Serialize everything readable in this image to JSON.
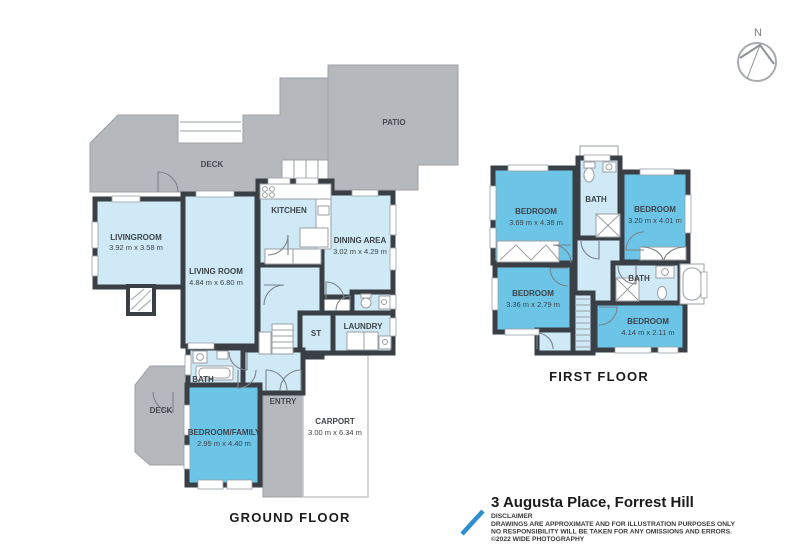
{
  "compass": {
    "label": "N"
  },
  "plan_title": "3 Augusta Place, Forrest Hill",
  "disclaimer": {
    "heading": "DISCLAIMER",
    "line1": "DRAWINGS ARE APPROXIMATE AND FOR ILLUSTRATION PURPOSES ONLY",
    "line2": "NO RESPONSIBILITY WILL BE TAKEN FOR ANY OMISSIONS AND ERRORS.",
    "line3": "©2022 WIDE PHOTOGRAPHY"
  },
  "colors": {
    "wall": "#3a3f46",
    "room_light": "#cfe9f6",
    "room_medium": "#6cc4e7",
    "outdoor_gray": "#b5b8bc",
    "accent_blue": "#2e8fd0"
  },
  "ground_floor": {
    "label": "GROUND FLOOR",
    "outdoor": {
      "deck_top": "DECK",
      "patio": "PATIO",
      "deck_lower": "DECK",
      "entry": "ENTRY"
    },
    "rooms": {
      "livingroom": {
        "name": "LIVINGROOM",
        "dims": "3.92 m x 3.58 m"
      },
      "living_room": {
        "name": "LIVING ROOM",
        "dims": "4.84 m x 6.80 m"
      },
      "kitchen": {
        "name": "KITCHEN"
      },
      "dining_area": {
        "name": "DINING AREA",
        "dims": "3.02 m x 4.29 m"
      },
      "st": {
        "name": "ST"
      },
      "laundry": {
        "name": "LAUNDRY"
      },
      "bath": {
        "name": "BATH"
      },
      "bedroom_family": {
        "name": "BEDROOM/FAMILY",
        "dims": "2.95 m x 4.40 m"
      },
      "carport": {
        "name": "CARPORT",
        "dims": "3.00 m x 6.34 m"
      }
    }
  },
  "first_floor": {
    "label": "FIRST FLOOR",
    "rooms": {
      "bedroom_top_left": {
        "name": "BEDROOM",
        "dims": "3.69 m x 4.38 m"
      },
      "bath_top": {
        "name": "BATH"
      },
      "bedroom_top_right": {
        "name": "BEDROOM",
        "dims": "3.20 m x 4.01 m"
      },
      "bedroom_mid_left": {
        "name": "BEDROOM",
        "dims": "3.36 m x 2.79 m"
      },
      "bath_right": {
        "name": "BATH"
      },
      "bedroom_bottom_right": {
        "name": "BEDROOM",
        "dims": "4.14 m x 2.11 m"
      }
    }
  }
}
